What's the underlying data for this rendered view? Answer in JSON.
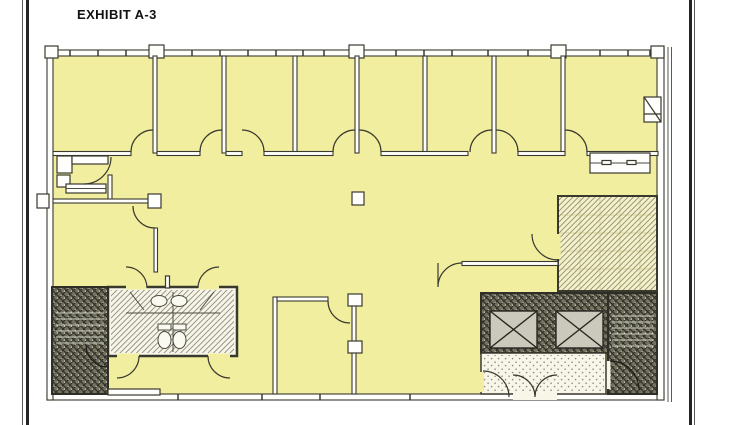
{
  "page": {
    "title": "EXHIBIT A-3"
  },
  "colors": {
    "paper": "#ffffff",
    "border_dark": "#242424",
    "border_gray": "#5a5a55",
    "plan_fill": "#f1eea0",
    "wall": "#3a392e",
    "wall_fill": "#fefefc",
    "hatch_dark_bg": "#73725f",
    "hatch_dark_line": "#33322a",
    "hatch_dark_speck": "#d8d6c8",
    "hatch_light_bg": "#f7f5e8",
    "hatch_light_line": "#8f8e80",
    "storage_bg": "#f4f1c6",
    "storage_grid": "#dcd79c",
    "stipple_bg": "#f8f6e8",
    "stipple_dot": "#8e8d7f",
    "elevator_fill": "#cbc9bb",
    "fixture": "#4b4a3f",
    "tread": "#cecdc0"
  },
  "floor_plan": {
    "regions": [
      {
        "name": "perimeter-offices",
        "count": 7
      },
      {
        "name": "corner-room",
        "count": 1
      },
      {
        "name": "open-office-area",
        "count": 1
      },
      {
        "name": "kitchenette-closet",
        "count": 1
      },
      {
        "name": "left-office",
        "count": 1
      },
      {
        "name": "lower-office",
        "count": 1
      },
      {
        "name": "restroom-core",
        "count": 1
      },
      {
        "name": "stairwell-left",
        "count": 1
      },
      {
        "name": "elevator-core",
        "elevators": 2
      },
      {
        "name": "stairwell-right",
        "count": 1
      },
      {
        "name": "lobby-vestibule",
        "count": 1
      },
      {
        "name": "storage-room",
        "count": 1
      }
    ]
  }
}
